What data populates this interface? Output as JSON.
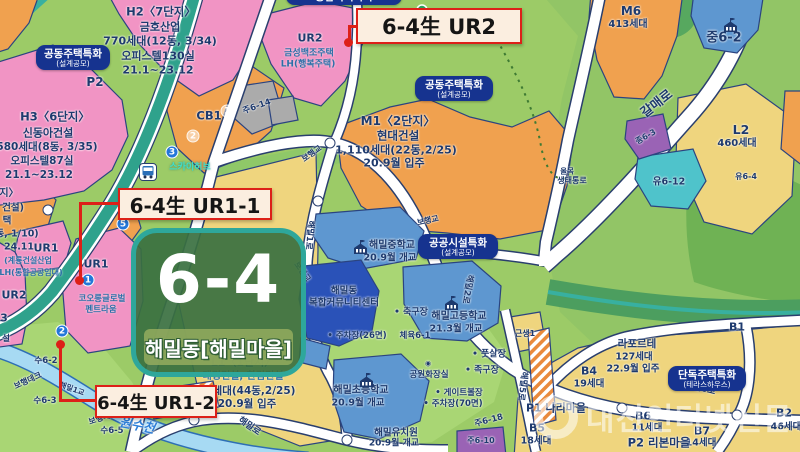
{
  "district_badge": {
    "code": "6-4",
    "name": "해밀동[해밀마을]"
  },
  "callouts": {
    "ur2": {
      "label": "6-4生 UR2"
    },
    "ur1_1": {
      "label": "6-4生 UR1-1"
    },
    "ur1_2": {
      "label": "6-4生 UR1-2"
    }
  },
  "special_badges": {
    "top": {
      "line1": "종합복지특화",
      "line2": ""
    },
    "apt1": {
      "line1": "공동주택특화",
      "line2": "(설계공모)"
    },
    "apt2": {
      "line1": "공동주택특화",
      "line2": "(설계공모)"
    },
    "pub": {
      "line1": "공공시설특화",
      "line2": "(설계공모)"
    },
    "dan": {
      "line1": "단독주택특화",
      "line2": "(테라스하우스)"
    }
  },
  "watermark": {
    "text": "대전인터넷신문"
  },
  "palette": {
    "base_green": "#9CCB67",
    "park_green": "#A9D674",
    "hill_green": "#6FB254",
    "pink_zone": "#F194C4",
    "orange_zone": "#F0A14F",
    "yellow_zone": "#EFD57E",
    "blue_zone": "#5E97D0",
    "dark_blue_zone": "#2A52B8",
    "teal_parcel": "#4FC3CB",
    "purple_parcel": "#9A63B5",
    "gray_parcel": "#ABABAB",
    "brt_teal": "#2FA28C",
    "stream_blue": "#A7DAF3",
    "callout_red": "#DD2018",
    "badge_navy": "#16338F",
    "badge_green": "#3A7040",
    "navy_text": "#1E3A6E"
  },
  "map_labels": [
    [
      "H2〈7단지〉",
      161,
      12,
      11.5,
      "n",
      1
    ],
    [
      "금호산업",
      160,
      27,
      11,
      "n",
      1
    ],
    [
      "770세대(12동, 3/34)",
      160,
      41,
      11,
      "n",
      1
    ],
    [
      "오피스텔130실",
      158,
      56,
      11,
      "n",
      1
    ],
    [
      "21.1~23.12",
      158,
      70,
      11,
      "n",
      1
    ],
    [
      "H3〈6단지〉",
      55,
      117,
      11.5,
      "n",
      1
    ],
    [
      "신동아건설",
      48,
      133,
      11,
      "n",
      1
    ],
    [
      "580세대(8동, 3/35)",
      47,
      147,
      10.5,
      "n",
      1
    ],
    [
      "오피스텔87실",
      42,
      161,
      10.5,
      "n",
      1
    ],
    [
      "21.1~23.12",
      39,
      175,
      10.5,
      "n",
      1
    ],
    [
      "P2",
      95,
      82,
      12,
      "n",
      1
    ],
    [
      "UR2",
      310,
      38,
      11,
      "n",
      1
    ],
    [
      "금성백조주택",
      309,
      54,
      9,
      "b",
      1
    ],
    [
      "LH(행복주택)",
      308,
      65,
      9,
      "b",
      1
    ],
    [
      "녹6-3",
      508,
      34,
      9,
      "g",
      1
    ],
    [
      "M1〈2단지〉",
      398,
      121,
      12,
      "n",
      1
    ],
    [
      "현대건설",
      398,
      136,
      11.5,
      "n",
      1
    ],
    [
      "1,110세대(22동,2/25)",
      396,
      150,
      11,
      "n",
      1
    ],
    [
      "20.9월 입주",
      394,
      163,
      11,
      "n",
      1
    ],
    [
      "M6",
      631,
      11,
      12,
      "n",
      1
    ],
    [
      "413세대",
      628,
      25,
      10,
      "n",
      1
    ],
    [
      "중6-2",
      724,
      38,
      13,
      "n",
      1
    ],
    [
      "갈매로",
      657,
      104,
      13,
      "n",
      1,
      -38
    ],
    [
      "종6-3",
      646,
      137,
      8,
      "n",
      1,
      -30
    ],
    [
      "유6-12",
      669,
      182,
      9.5,
      "n",
      1
    ],
    [
      "L2",
      741,
      130,
      12.5,
      "n",
      1
    ],
    [
      "460세대",
      737,
      144,
      10,
      "n",
      1
    ],
    [
      "유6-4",
      746,
      177,
      8,
      "n",
      1
    ],
    [
      "올목",
      567,
      171,
      7.5,
      "n",
      1
    ],
    [
      "생태통로",
      572,
      181,
      8,
      "n",
      1
    ],
    [
      "보행교",
      312,
      154,
      8,
      "n",
      1,
      -35
    ],
    [
      "보행교",
      428,
      221,
      8,
      "n",
      1,
      -12
    ],
    [
      "보행교",
      302,
      272,
      8,
      "n",
      1,
      55
    ],
    [
      "해밀1로",
      309,
      235,
      8.5,
      "n",
      1,
      95
    ],
    [
      "해밀2로",
      467,
      289,
      8.5,
      "n",
      1,
      100
    ],
    [
      "해밀5로",
      522,
      386,
      8.5,
      "n",
      1,
      97
    ],
    [
      "해밀6로",
      700,
      389,
      9,
      "n",
      1,
      14
    ],
    [
      "해밀로",
      249,
      427,
      9,
      "n",
      1,
      35
    ],
    [
      "CB1",
      209,
      116,
      11.5,
      "n",
      1
    ],
    [
      "주6-14",
      257,
      107,
      8.5,
      "n",
      1,
      -20
    ],
    [
      "스카이허브",
      190,
      168,
      9,
      "c",
      1
    ],
    [
      "UR1",
      46,
      248,
      11,
      "n",
      1
    ],
    [
      "UR1",
      96,
      264,
      11,
      "n",
      1
    ],
    [
      "UR2",
      14,
      295,
      11,
      "n",
      1
    ],
    [
      "코오롱글로벌",
      102,
      299,
      8.5,
      "b",
      1
    ],
    [
      "펜트라움",
      101,
      310,
      8.5,
      "b",
      1
    ],
    [
      "(계룡건설산업",
      28,
      261,
      8,
      "b",
      1
    ],
    [
      "LH(통합공공임대)",
      31,
      273,
      8,
      "b",
      1
    ],
    [
      "지〉",
      9,
      194,
      10,
      "n",
      1
    ],
    [
      "건설)",
      13,
      208,
      9.5,
      "n",
      1
    ],
    [
      "택",
      7,
      221,
      9.5,
      "n",
      1
    ],
    [
      "동, 1/10)",
      17,
      234,
      9.5,
      "n",
      1
    ],
    [
      "24.11",
      19,
      247,
      9.5,
      "n",
      1
    ],
    [
      "3",
      4,
      318,
      11,
      "n",
      1
    ],
    [
      "설",
      6,
      339,
      8.5,
      "n",
      1
    ],
    [
      "해밀중학교",
      392,
      246,
      10,
      "n",
      1
    ],
    [
      "20.9월 개교",
      390,
      258,
      9.5,
      "n",
      1
    ],
    [
      "해밀고등학교",
      459,
      317,
      10,
      "n",
      1
    ],
    [
      "21.3월 개교",
      456,
      329,
      9.5,
      "n",
      1
    ],
    [
      "해밀동",
      344,
      291,
      9.5,
      "n",
      1
    ],
    [
      "복합커뮤니티센터",
      344,
      303,
      9.5,
      "n",
      1
    ],
    [
      "해밀초등학교",
      361,
      391,
      10,
      "n",
      1
    ],
    [
      "20.9월 개교",
      358,
      403,
      9.5,
      "n",
      1
    ],
    [
      "해밀유치원",
      396,
      433,
      9.5,
      "n",
      1
    ],
    [
      "20.9월 개교",
      394,
      444,
      9,
      "n",
      1
    ],
    [
      "• 축구장",
      411,
      313,
      9,
      "n",
      1
    ],
    [
      "체육6-1",
      415,
      336,
      8.5,
      "n",
      1
    ],
    [
      "• 주차장(26면)",
      357,
      336,
      8.5,
      "n",
      1
    ],
    [
      "• 풋살장",
      489,
      355,
      9,
      "n",
      1
    ],
    [
      "• 족구장",
      482,
      371,
      9,
      "n",
      1
    ],
    [
      "◉",
      428,
      364,
      7,
      "n",
      0
    ],
    [
      "공원화장실",
      429,
      375,
      8.5,
      "n",
      1
    ],
    [
      "• 게이트볼장",
      459,
      393,
      8.5,
      "n",
      1
    ],
    [
      "• 주차장(70면)",
      453,
      404,
      8.5,
      "n",
      1
    ],
    [
      "주6-18",
      489,
      421,
      8.5,
      "n",
      1,
      -15
    ],
    [
      "주6-10",
      481,
      441,
      8,
      "n",
      1
    ],
    [
      "근생1",
      525,
      334,
      8,
      "n",
      1
    ],
    [
      "L1〈1단지〉",
      243,
      362,
      11,
      "n",
      1
    ],
    [
      "대명건설, 한림건설",
      243,
      377,
      10,
      "b",
      1
    ],
    [
      "세대(44동,2/25)",
      254,
      391,
      10.5,
      "n",
      1
    ],
    [
      "20.9월 입주",
      247,
      404,
      10.5,
      "n",
      1
    ],
    [
      "수6-2",
      46,
      361,
      8.5,
      "n",
      1
    ],
    [
      "보행데크",
      28,
      381,
      8,
      "n",
      1,
      -25
    ],
    [
      "해밀1교",
      72,
      389,
      7.5,
      "n",
      1,
      20
    ],
    [
      "수6-3",
      45,
      401,
      8.5,
      "n",
      1
    ],
    [
      "보행데크",
      103,
      418,
      8,
      "n",
      1,
      -18
    ],
    [
      "수6-5",
      112,
      431,
      8.5,
      "n",
      1
    ],
    [
      "원수천",
      137,
      426,
      13,
      "s",
      1,
      12
    ],
    [
      "라포르테",
      637,
      344,
      10.5,
      "n",
      1
    ],
    [
      "127세대",
      634,
      357,
      9.5,
      "n",
      1
    ],
    [
      "22.9월 입주",
      633,
      369,
      9.5,
      "n",
      1
    ],
    [
      "B1",
      737,
      327,
      11,
      "n",
      1
    ],
    [
      "B4",
      589,
      371,
      11,
      "n",
      1
    ],
    [
      "19세대",
      589,
      384,
      9.5,
      "n",
      1
    ],
    [
      "B5",
      537,
      428,
      11,
      "n",
      1
    ],
    [
      "18세대",
      536,
      441,
      9.5,
      "n",
      1
    ],
    [
      "B6",
      643,
      416,
      11,
      "n",
      1
    ],
    [
      "11세대",
      647,
      428,
      9.5,
      "n",
      1
    ],
    [
      "B7",
      702,
      431,
      11,
      "n",
      1
    ],
    [
      "14세대",
      701,
      443,
      9.5,
      "n",
      1
    ],
    [
      "B2",
      784,
      413,
      11,
      "n",
      1
    ],
    [
      "46세대",
      786,
      427,
      9.5,
      "n",
      1
    ],
    [
      "P1 나리마을",
      556,
      408,
      11,
      "n",
      1
    ],
    [
      "P2 리본마을",
      659,
      443,
      11.5,
      "n",
      1
    ]
  ],
  "circles": [
    {
      "n": "1",
      "x": 88,
      "y": 280,
      "s": "blue"
    },
    {
      "n": "2",
      "x": 62,
      "y": 331,
      "s": "blue"
    },
    {
      "n": "3",
      "x": 172,
      "y": 152,
      "s": "blue"
    },
    {
      "n": "5",
      "x": 123,
      "y": 224,
      "s": "blue"
    },
    {
      "n": "1",
      "x": 227,
      "y": 111,
      "s": "light"
    },
    {
      "n": "2",
      "x": 193,
      "y": 136,
      "s": "light"
    },
    {
      "n": "",
      "x": 330,
      "y": 143,
      "s": "road"
    },
    {
      "n": "",
      "x": 48,
      "y": 210,
      "s": "road"
    },
    {
      "n": "",
      "x": 318,
      "y": 201,
      "s": "road"
    },
    {
      "n": "",
      "x": 194,
      "y": 420,
      "s": "road"
    },
    {
      "n": "",
      "x": 347,
      "y": 440,
      "s": "road"
    },
    {
      "n": "",
      "x": 622,
      "y": 408,
      "s": "road"
    },
    {
      "n": "",
      "x": 737,
      "y": 415,
      "s": "road"
    }
  ],
  "icons": [
    {
      "t": "school",
      "x": 352,
      "y": 240
    },
    {
      "t": "school",
      "x": 443,
      "y": 296
    },
    {
      "t": "school",
      "x": 358,
      "y": 373
    },
    {
      "t": "school",
      "x": 722,
      "y": 18
    },
    {
      "t": "bus",
      "x": 139,
      "y": 163
    },
    {
      "t": "pin",
      "x": 416,
      "y": 4
    }
  ]
}
